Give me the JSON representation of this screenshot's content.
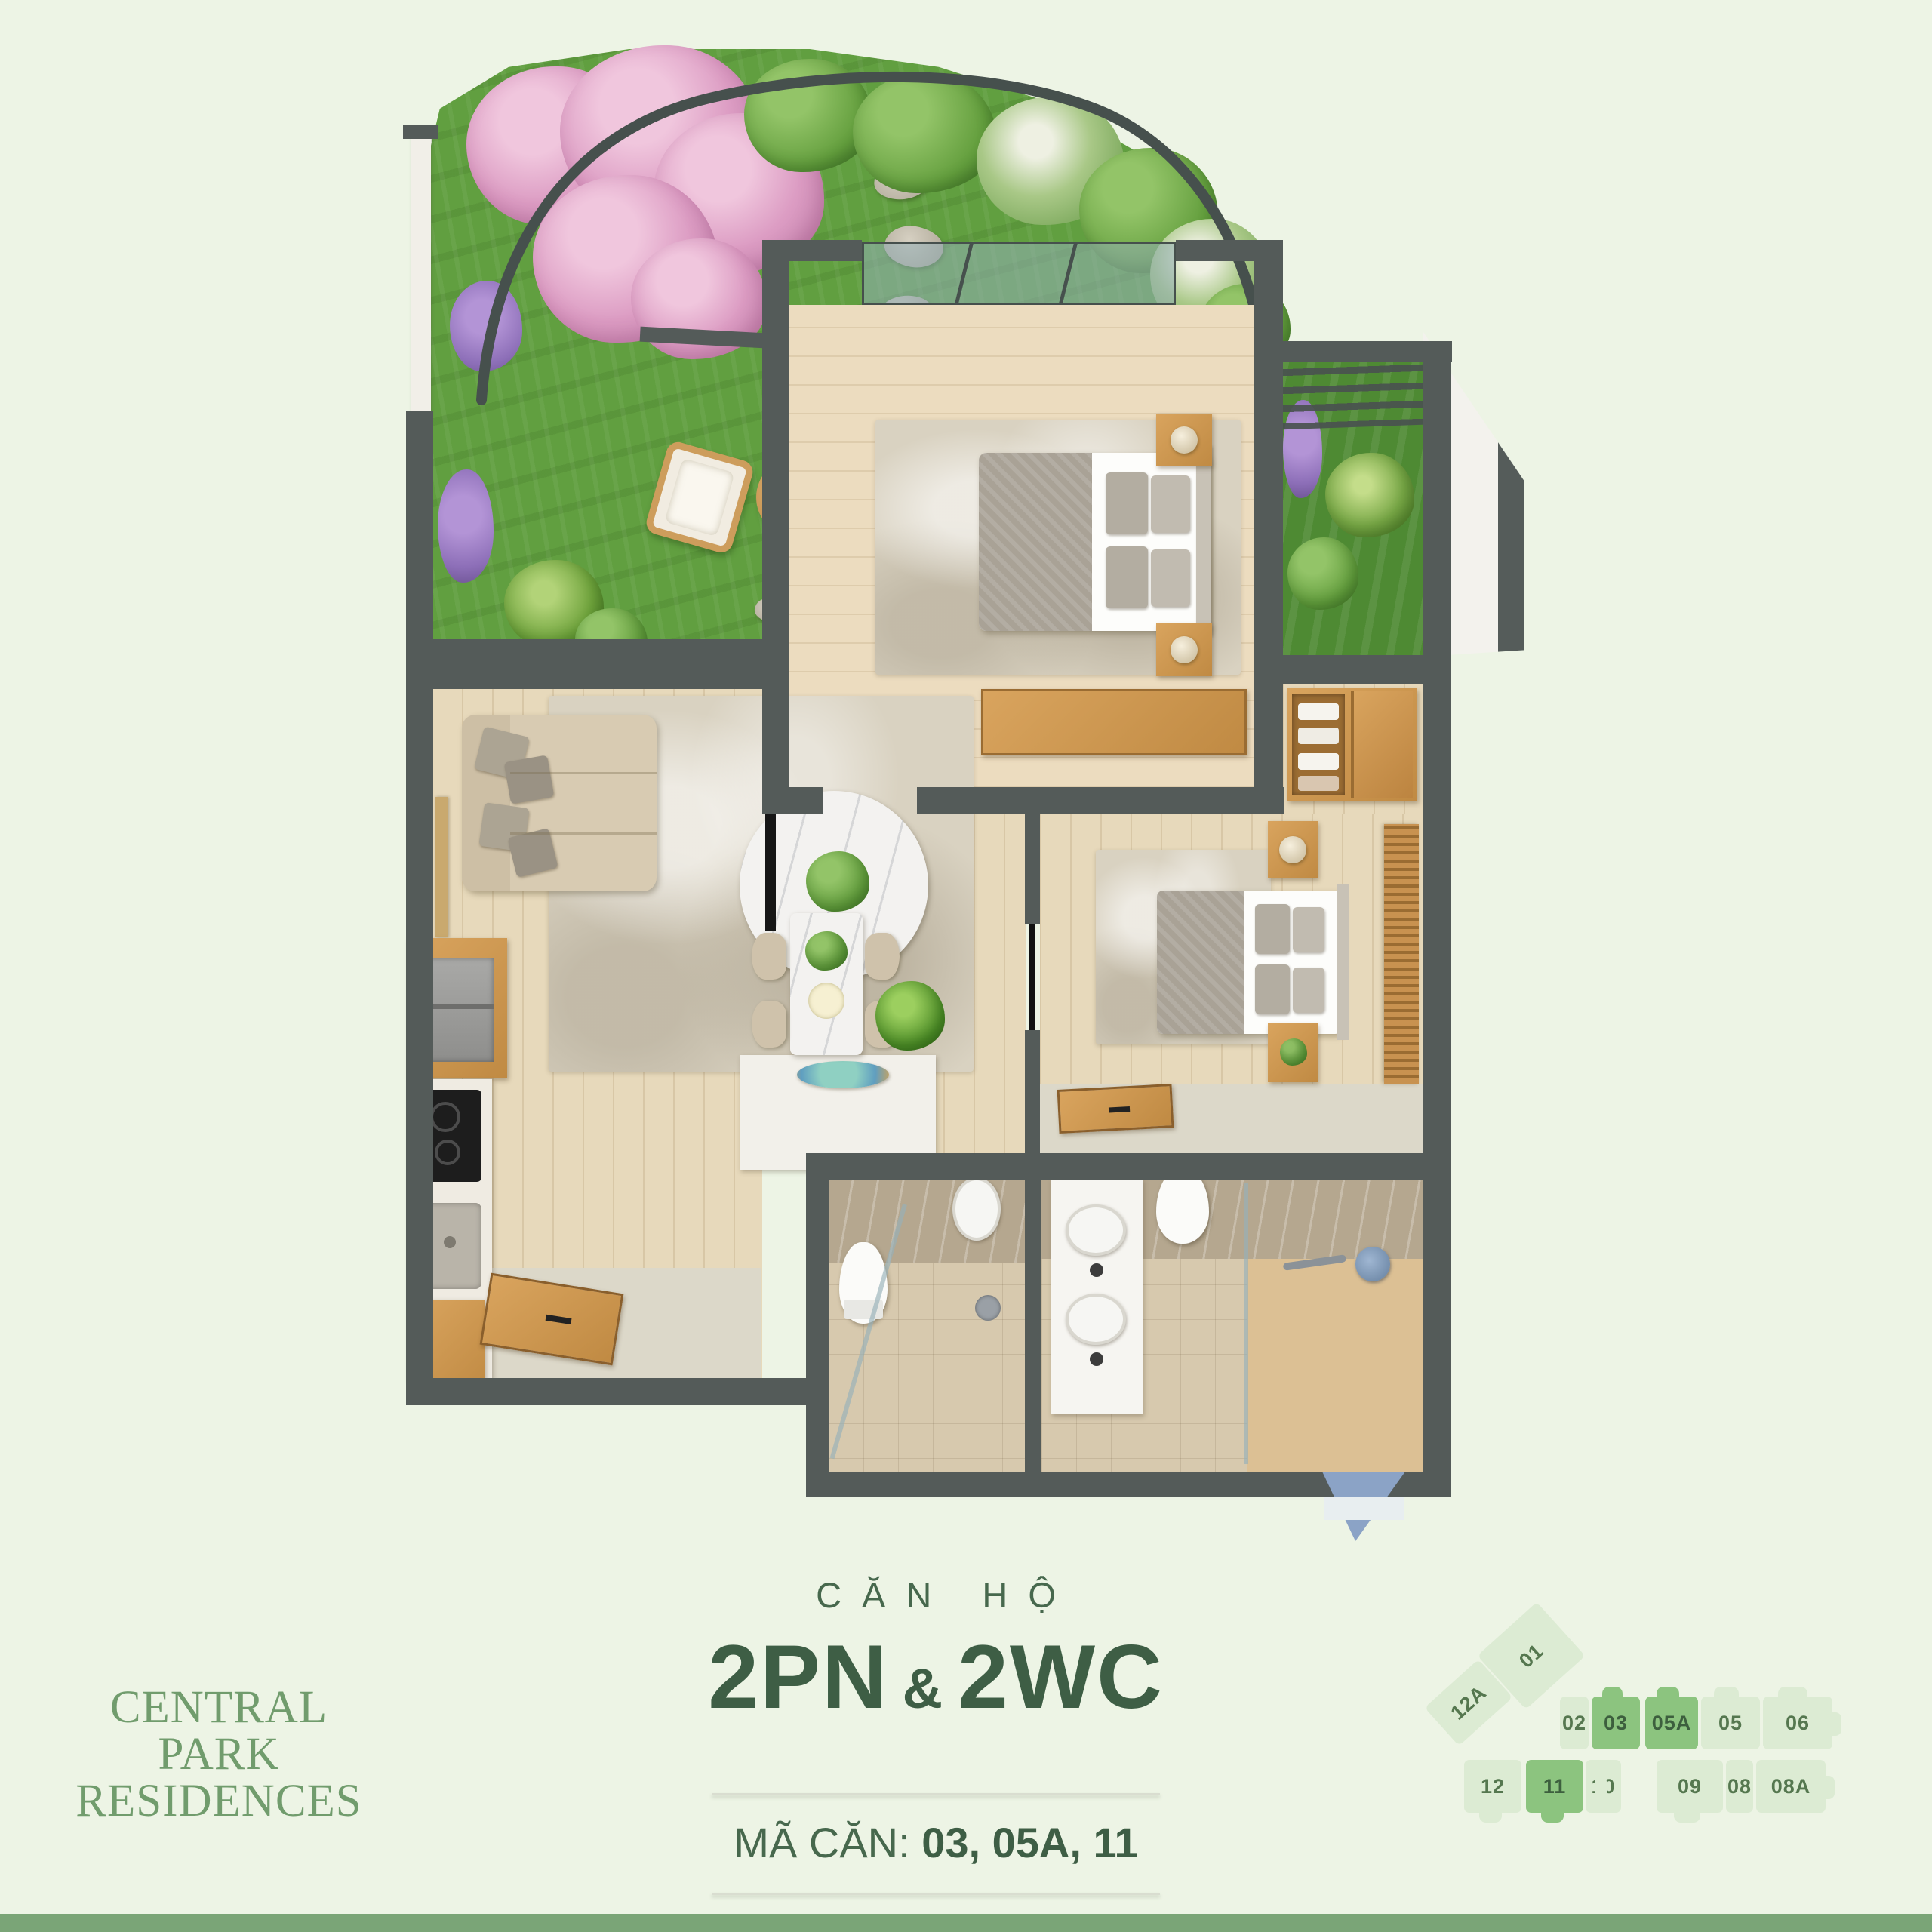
{
  "page": {
    "background": "#edf4e5",
    "footer_bar_color": "#7aa577"
  },
  "logo": {
    "line1": "CENTRAL",
    "line2": "PARK",
    "line3": "RESIDENCES",
    "color": "#719c6d"
  },
  "title": {
    "kicker": "CĂN HỘ",
    "main_left": "2PN",
    "amp": "&",
    "main_right": "2WC",
    "code_label": "MÃ CĂN:",
    "code_values": "03, 05A, 11",
    "text_color": "#3e5e45"
  },
  "keyplan": {
    "unit_color": "#dcebd3",
    "highlight_color": "#8cc47f",
    "label_color": "#55774f",
    "units": [
      {
        "label": "01",
        "highlighted": false
      },
      {
        "label": "12A",
        "highlighted": false
      },
      {
        "label": "02",
        "highlighted": false
      },
      {
        "label": "03",
        "highlighted": true
      },
      {
        "label": "05A",
        "highlighted": true
      },
      {
        "label": "05",
        "highlighted": false
      },
      {
        "label": "06",
        "highlighted": false
      },
      {
        "label": "12",
        "highlighted": false
      },
      {
        "label": "11",
        "highlighted": true
      },
      {
        "label": "10",
        "highlighted": false
      },
      {
        "label": "09",
        "highlighted": false
      },
      {
        "label": "08",
        "highlighted": false
      },
      {
        "label": "08A",
        "highlighted": false
      }
    ]
  },
  "floor_plan": {
    "wall_color": "#545b59",
    "wood_floor_color": "#e7d9bb",
    "grass_color": "#619f40",
    "areas": [
      "terrace-garden",
      "living-room",
      "kitchen",
      "dining-area",
      "bedroom-1",
      "balcony",
      "wardrobe",
      "bedroom-2",
      "bathroom-1",
      "bathroom-2",
      "entry"
    ]
  }
}
